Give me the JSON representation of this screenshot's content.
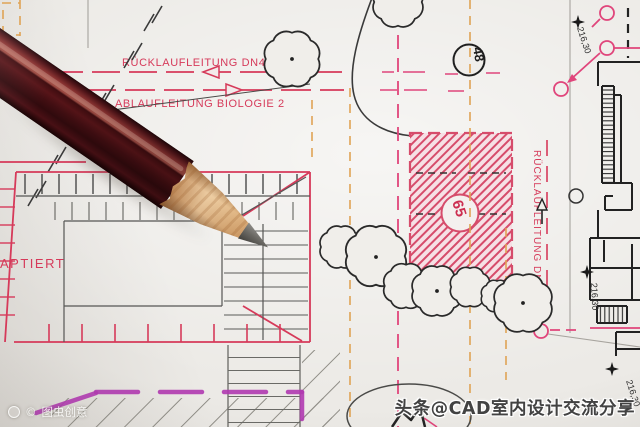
{
  "drawing": {
    "labels": {
      "pipe_return": "RÜCKLAUFLEITUNG DN400",
      "pipe_outfall": "ABLAUFLEITUNG BIOLOGIE 2",
      "pipe_return_vertical": "RÜCKLAUFLEITUNG DN400",
      "adaptiert": "APTIERT",
      "node_48": "48",
      "node_65": "65",
      "elevation_top_right": "216,30",
      "elevation_mid_right": "216,30",
      "elevation_bottom_right": "216,30"
    },
    "colors": {
      "ink_red": "#d63a5a",
      "hatch_pink": "#d64c6b",
      "guide_orange": "#dfa355",
      "highlight_magenta": "#b13ab1",
      "line_black": "#2e2e2e",
      "paper": "#eceae6"
    }
  },
  "watermarks": {
    "toutiao": "头条@CAD室内设计交流分享",
    "stock_copyright": "©",
    "stock_name": "图虫创意"
  }
}
